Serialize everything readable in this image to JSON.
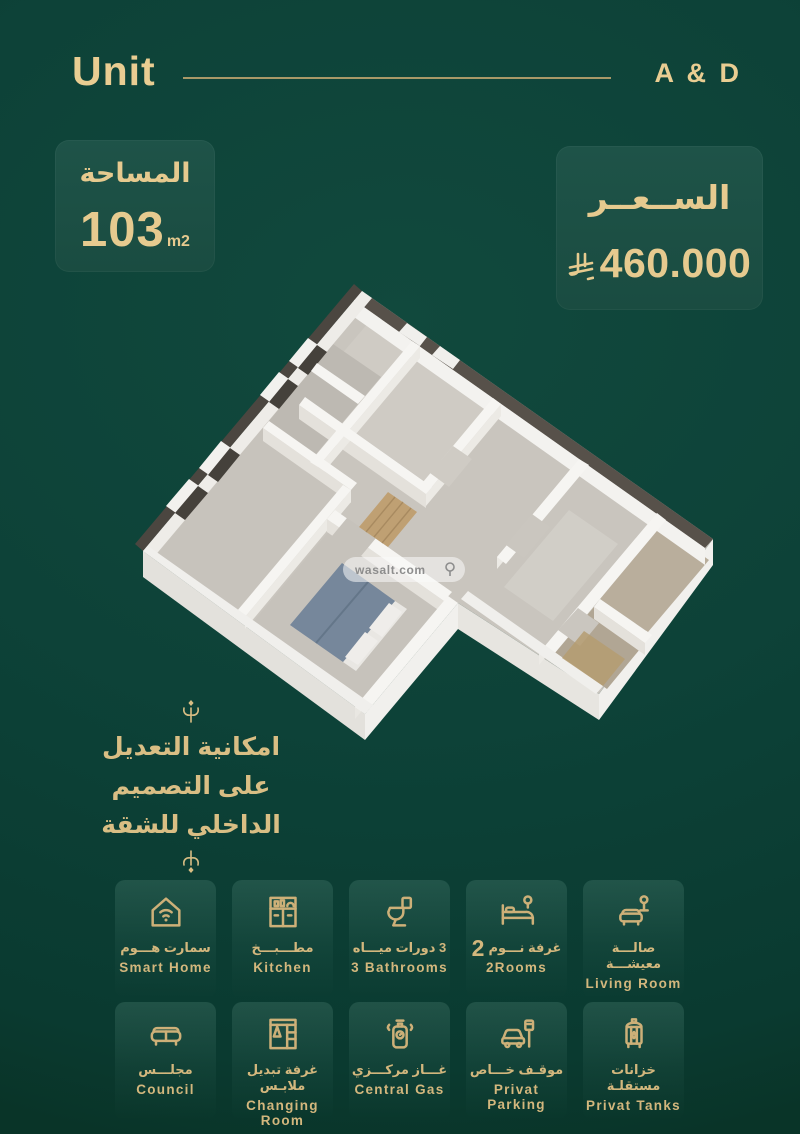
{
  "header": {
    "left_label": "Unit",
    "right_label": "A & D"
  },
  "area_box": {
    "title": "المساحة",
    "value": "103",
    "unit": "m2"
  },
  "price_box": {
    "title": "الســعــر",
    "value": "460.000",
    "currency_symbol": "SAR"
  },
  "floorplan": {
    "watermark_label": "wasalt.com"
  },
  "note": {
    "line1": "امكانية التعديل",
    "line2": "على التصميم",
    "line3": "الداخلي للشقة"
  },
  "features": {
    "items": [
      {
        "ar": "سمارت هـــوم",
        "en": "Smart Home",
        "icon": "smart-home"
      },
      {
        "ar": "مطـــبـــخ",
        "en": "Kitchen",
        "icon": "kitchen"
      },
      {
        "ar": "3 دورات ميـــاه",
        "en": "3 Bathrooms",
        "icon": "toilet"
      },
      {
        "ar": "غرفة نـــوم",
        "num": "2",
        "en": "2Rooms",
        "icon": "bed"
      },
      {
        "ar": "صالـــة معيشـــة",
        "en": "Living Room",
        "icon": "sofa-lamp"
      },
      {
        "ar": "مجلـــس",
        "en": "Council",
        "icon": "council-sofa"
      },
      {
        "ar": "غرفة تبديل ملابـس",
        "en": "Changing Room",
        "icon": "wardrobe"
      },
      {
        "ar": "غـــاز مركـــزي",
        "en": "Central Gas",
        "icon": "gas-cylinder"
      },
      {
        "ar": "موقـف خـــاص",
        "en": "Privat Parking",
        "icon": "car-parking"
      },
      {
        "ar": "خزانات مستقلـة",
        "en": "Privat Tanks",
        "icon": "water-tank"
      }
    ]
  },
  "colors": {
    "background": "#0d4238",
    "gold": "#e6ca8f",
    "gold_dim": "#d3b77d",
    "box_bg": "#1c4f44",
    "floor_gray": "#c9c5be",
    "wall_white": "#f4f3f0",
    "bed_blanket": "#76879b",
    "bath_floor": "#b9ae9c"
  }
}
